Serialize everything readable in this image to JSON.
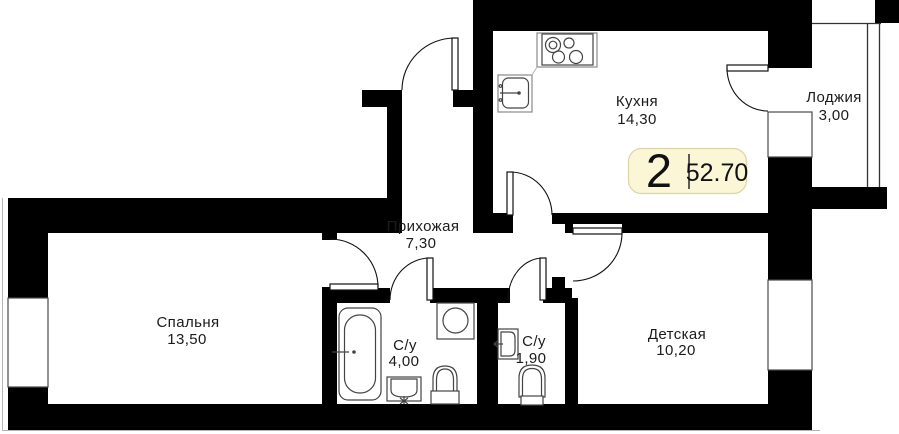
{
  "floorplan": {
    "title": "2-room apartment floor plan",
    "badge": {
      "rooms_count": "2",
      "total_area": "52.70"
    },
    "rooms": [
      {
        "name": "kitchen",
        "label": "Кухня",
        "area": "14,30"
      },
      {
        "name": "loggia",
        "label": "Лоджия",
        "area": "3,00"
      },
      {
        "name": "hallway",
        "label": "Прихожая",
        "area": "7,30"
      },
      {
        "name": "bedroom",
        "label": "Спальня",
        "area": "13,50"
      },
      {
        "name": "bathroom",
        "label": "С/у",
        "area": "4,00"
      },
      {
        "name": "wc",
        "label": "С/у",
        "area": "1,90"
      },
      {
        "name": "children",
        "label": "Детская",
        "area": "10,20"
      }
    ],
    "fixtures": [
      "stove-icon",
      "kitchen-sink-icon",
      "bathtub-icon",
      "washing-machine-icon",
      "toilet-icon",
      "pedestal-sink-icon",
      "wall-sink-icon",
      "toilet-icon"
    ],
    "colors": {
      "wall": "#000000",
      "line": "#333333",
      "badge_bg": "#FAF6D6",
      "badge_border": "#DCD5A4",
      "text": "#1b1b1b"
    }
  }
}
